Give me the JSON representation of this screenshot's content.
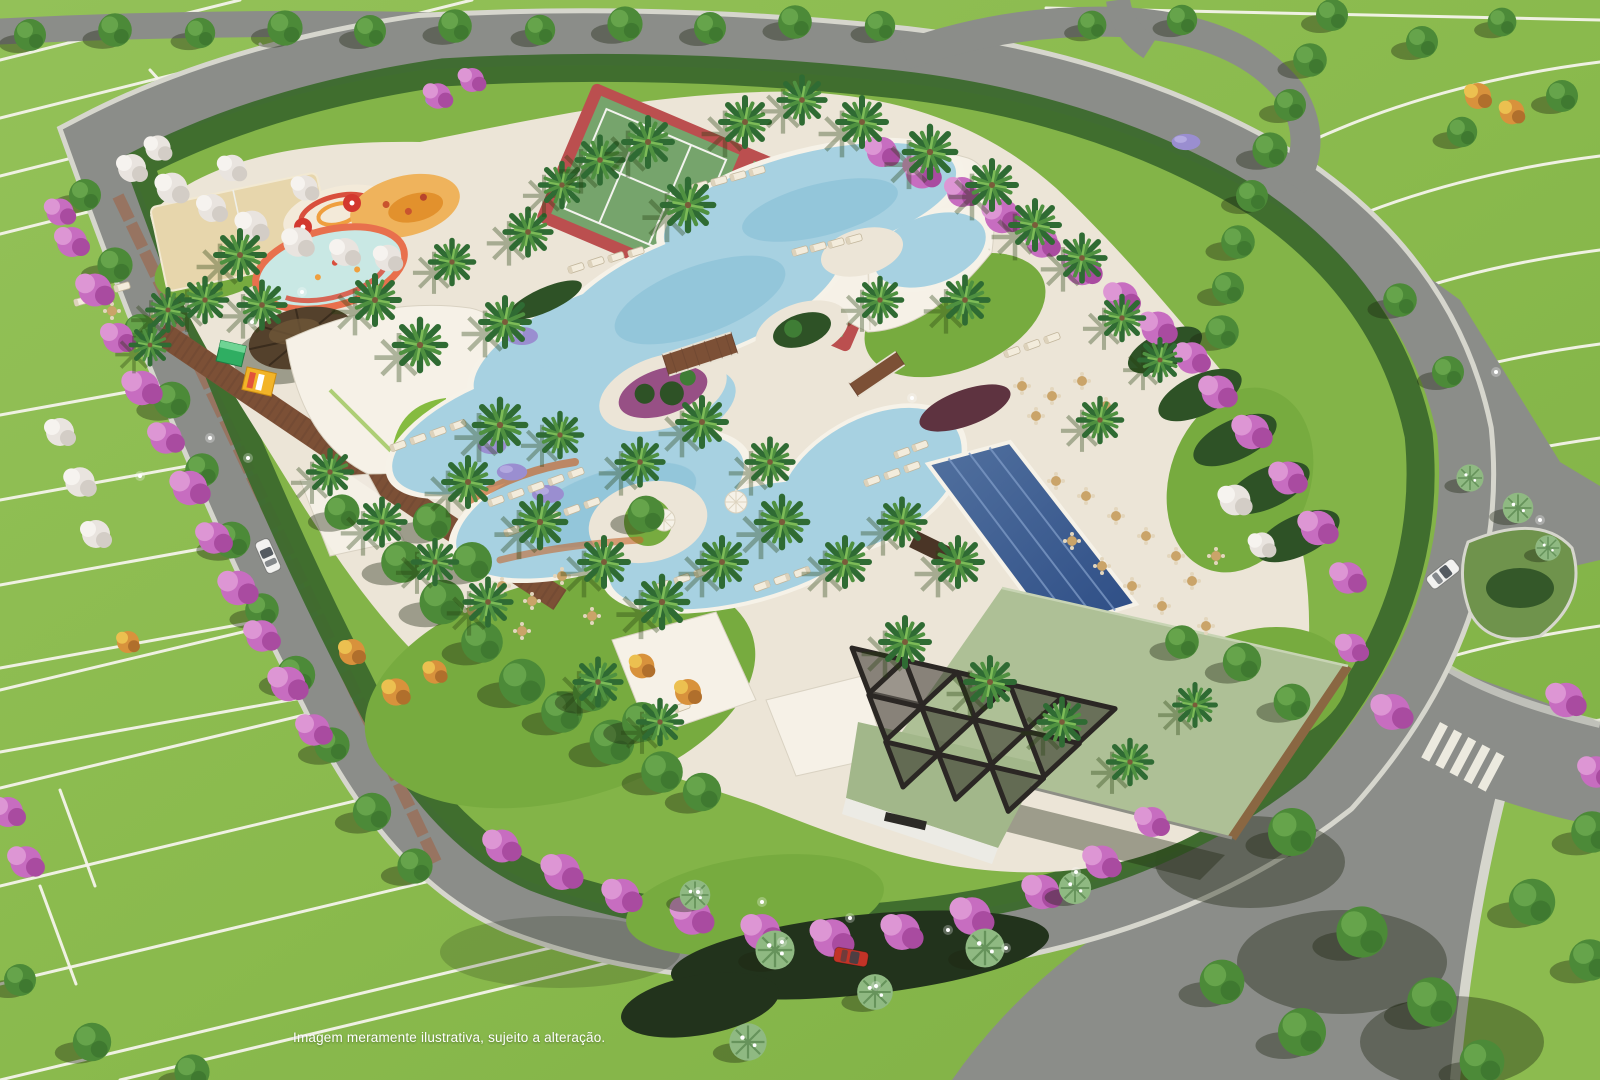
{
  "caption": {
    "text": "Imagem meramente ilustrativa, sujeito a alteração."
  },
  "palette": {
    "grass": "#8cbb4f",
    "grass_dark": "#7dae43",
    "lawn": "#83b448",
    "lawn2": "#77ab3f",
    "lot_line": "#f4f3ea",
    "road": "#8b8d89",
    "road_dark": "#7c7e7a",
    "sidewalk": "#d6d6cd",
    "deck": "#ece5d7",
    "deck_light": "#f6f1e7",
    "sand": "#e7d6ac",
    "hedge": "#3c6a2d",
    "water": "#a7d1e1",
    "water_deep": "#84bdd6",
    "coping": "#f6f2e8",
    "lap1": "#49699f",
    "lap2": "#2d4d85",
    "lane": "#7b98c4",
    "roof": "#aec096",
    "roof2": "#a2b78a",
    "wood": "#8a6742",
    "trellis": "#2b2724",
    "wall": "#ecebe5",
    "thatch": "#54412c",
    "board": "#7c5036",
    "brick": "#9a6e58",
    "pink": "#c76dc0",
    "pink2": "#a94ba0",
    "pink3": "#dd96d4",
    "white_bloom": "#e9e4df",
    "purple": "#9a8ed0",
    "orange_bloom": "#d8923c",
    "tree": "#4c8a38",
    "tree_dark": "#3c742e",
    "tree_light": "#66a44b",
    "palm_dark": "#2f6b33",
    "palm_mid": "#4f9140",
    "palm_light": "#7cbb57",
    "fan_palm": "#8fb982",
    "trunk": "#7a5b3a",
    "tennis_red": "#bb4f4f",
    "tennis_green": "#76a46c",
    "kids_ring": "#e8704d",
    "splash_red": "#d94f3d",
    "splash_orange": "#ef9f3f",
    "play_sand": "#efb35c",
    "truck_green": "#2fae62",
    "truck_yellow": "#f2b428",
    "car_red": "#c23327",
    "car_white": "#f2f2f0",
    "umbrella_red": "#d3382f",
    "shrub": "#2e5226",
    "shadow": "rgba(28,38,16,0.38)"
  },
  "scene": {
    "palms": [
      [
        240,
        255,
        1
      ],
      [
        205,
        300,
        0.9
      ],
      [
        168,
        310,
        0.85
      ],
      [
        262,
        305,
        0.95
      ],
      [
        150,
        345,
        0.8
      ],
      [
        375,
        300,
        1
      ],
      [
        420,
        345,
        1.05
      ],
      [
        452,
        262,
        0.9
      ],
      [
        505,
        322,
        1
      ],
      [
        528,
        232,
        0.95
      ],
      [
        562,
        185,
        0.9
      ],
      [
        600,
        160,
        0.95
      ],
      [
        648,
        142,
        1
      ],
      [
        688,
        205,
        1.05
      ],
      [
        745,
        122,
        1
      ],
      [
        802,
        100,
        0.95
      ],
      [
        862,
        122,
        1
      ],
      [
        930,
        152,
        1.05
      ],
      [
        992,
        185,
        1
      ],
      [
        1035,
        225,
        1
      ],
      [
        1082,
        258,
        0.95
      ],
      [
        1122,
        318,
        0.9
      ],
      [
        1160,
        360,
        0.85
      ],
      [
        1100,
        420,
        0.9
      ],
      [
        500,
        425,
        1.05
      ],
      [
        468,
        482,
        1
      ],
      [
        540,
        522,
        1.05
      ],
      [
        604,
        562,
        1
      ],
      [
        662,
        602,
        1.05
      ],
      [
        722,
        562,
        1
      ],
      [
        782,
        522,
        1.05
      ],
      [
        845,
        562,
        1
      ],
      [
        902,
        522,
        0.95
      ],
      [
        958,
        562,
        1
      ],
      [
        770,
        462,
        0.95
      ],
      [
        702,
        422,
        1
      ],
      [
        640,
        462,
        0.95
      ],
      [
        560,
        435,
        0.9
      ],
      [
        905,
        642,
        1
      ],
      [
        990,
        682,
        1
      ],
      [
        1062,
        722,
        0.95
      ],
      [
        1130,
        762,
        0.9
      ],
      [
        1195,
        705,
        0.85
      ],
      [
        330,
        472,
        0.9
      ],
      [
        382,
        522,
        0.95
      ],
      [
        435,
        562,
        0.9
      ],
      [
        488,
        602,
        0.95
      ],
      [
        598,
        682,
        0.95
      ],
      [
        660,
        722,
        0.9
      ],
      [
        880,
        300,
        0.9
      ],
      [
        965,
        300,
        0.95
      ]
    ],
    "fan_palms": [
      [
        775,
        950,
        1.15
      ],
      [
        875,
        992,
        1.05
      ],
      [
        985,
        948,
        1.15
      ],
      [
        748,
        1042,
        1.1
      ],
      [
        1075,
        888,
        0.95
      ],
      [
        1470,
        478,
        0.8
      ],
      [
        1518,
        508,
        0.9
      ],
      [
        1548,
        548,
        0.75
      ],
      [
        695,
        895,
        0.9
      ]
    ],
    "trees": [
      [
        30,
        35,
        1
      ],
      [
        115,
        30,
        1.05
      ],
      [
        200,
        33,
        0.95
      ],
      [
        285,
        28,
        1.1
      ],
      [
        370,
        31,
        1
      ],
      [
        455,
        26,
        1.05
      ],
      [
        540,
        30,
        0.95
      ],
      [
        625,
        24,
        1.1
      ],
      [
        710,
        28,
        1
      ],
      [
        795,
        22,
        1.05
      ],
      [
        880,
        26,
        0.95
      ],
      [
        85,
        195,
        1
      ],
      [
        115,
        265,
        1.1
      ],
      [
        140,
        330,
        1
      ],
      [
        172,
        400,
        1.15
      ],
      [
        202,
        470,
        1.05
      ],
      [
        232,
        540,
        1.15
      ],
      [
        262,
        610,
        1.05
      ],
      [
        296,
        675,
        1.2
      ],
      [
        332,
        745,
        1.1
      ],
      [
        372,
        812,
        1.2
      ],
      [
        415,
        866,
        1.1
      ],
      [
        1332,
        15,
        1
      ],
      [
        1310,
        60,
        1.05
      ],
      [
        1290,
        105,
        1
      ],
      [
        1270,
        150,
        1.1
      ],
      [
        1252,
        196,
        1
      ],
      [
        1238,
        242,
        1.05
      ],
      [
        1228,
        288,
        1
      ],
      [
        1222,
        332,
        1.05
      ],
      [
        1092,
        25,
        0.9
      ],
      [
        1182,
        20,
        0.95
      ],
      [
        1422,
        42,
        1
      ],
      [
        1502,
        22,
        0.9
      ],
      [
        1562,
        96,
        1
      ],
      [
        1462,
        132,
        0.95
      ],
      [
        1400,
        300,
        1.05
      ],
      [
        1448,
        372,
        1
      ],
      [
        1292,
        832,
        1.5
      ],
      [
        1362,
        932,
        1.6
      ],
      [
        1302,
        1032,
        1.5
      ],
      [
        1432,
        1002,
        1.55
      ],
      [
        1532,
        902,
        1.45
      ],
      [
        1592,
        832,
        1.3
      ],
      [
        1482,
        1062,
        1.4
      ],
      [
        1222,
        982,
        1.4
      ],
      [
        1590,
        960,
        1.3
      ],
      [
        92,
        1042,
        1.2
      ],
      [
        192,
        1072,
        1.1
      ],
      [
        20,
        980,
        1
      ],
      [
        402,
        562,
        1.3
      ],
      [
        442,
        602,
        1.4
      ],
      [
        482,
        642,
        1.3
      ],
      [
        522,
        682,
        1.45
      ],
      [
        562,
        712,
        1.3
      ],
      [
        612,
        742,
        1.4
      ],
      [
        662,
        772,
        1.3
      ],
      [
        702,
        792,
        1.2
      ],
      [
        432,
        522,
        1.2
      ],
      [
        472,
        562,
        1.25
      ],
      [
        592,
        692,
        1.2
      ],
      [
        642,
        722,
        1.25
      ],
      [
        342,
        512,
        1.1
      ],
      [
        646,
        514,
        1.15
      ],
      [
        1242,
        662,
        1.2
      ],
      [
        1292,
        702,
        1.15
      ],
      [
        1182,
        642,
        1.05
      ]
    ],
    "pink_trees": [
      [
        60,
        212,
        0.9
      ],
      [
        72,
        242,
        1
      ],
      [
        95,
        290,
        1.1
      ],
      [
        118,
        338,
        1
      ],
      [
        142,
        388,
        1.15
      ],
      [
        166,
        438,
        1.05
      ],
      [
        190,
        488,
        1.15
      ],
      [
        214,
        538,
        1.05
      ],
      [
        238,
        588,
        1.15
      ],
      [
        262,
        636,
        1.05
      ],
      [
        288,
        684,
        1.15
      ],
      [
        314,
        730,
        1.05
      ],
      [
        882,
        152,
        1
      ],
      [
        922,
        172,
        1.1
      ],
      [
        962,
        192,
        1
      ],
      [
        1002,
        216,
        1.15
      ],
      [
        1042,
        242,
        1.05
      ],
      [
        1082,
        268,
        1.15
      ],
      [
        1122,
        298,
        1.05
      ],
      [
        1158,
        328,
        1.1
      ],
      [
        1192,
        358,
        1.05
      ],
      [
        1218,
        392,
        1.1
      ],
      [
        1252,
        432,
        1.15
      ],
      [
        1288,
        478,
        1.1
      ],
      [
        1318,
        528,
        1.15
      ],
      [
        1348,
        578,
        1.05
      ],
      [
        502,
        846,
        1.1
      ],
      [
        562,
        872,
        1.2
      ],
      [
        622,
        896,
        1.15
      ],
      [
        692,
        916,
        1.25
      ],
      [
        762,
        932,
        1.2
      ],
      [
        832,
        938,
        1.25
      ],
      [
        902,
        932,
        1.2
      ],
      [
        972,
        916,
        1.25
      ],
      [
        1042,
        892,
        1.15
      ],
      [
        1102,
        862,
        1.1
      ],
      [
        1152,
        822,
        1
      ],
      [
        1392,
        712,
        1.2
      ],
      [
        1566,
        700,
        1.15
      ],
      [
        1596,
        772,
        1.05
      ],
      [
        1352,
        648,
        0.95
      ],
      [
        8,
        812,
        1
      ],
      [
        26,
        862,
        1.05
      ],
      [
        438,
        96,
        0.85
      ],
      [
        472,
        80,
        0.8
      ]
    ],
    "white_trees": [
      [
        132,
        168,
        1
      ],
      [
        172,
        188,
        1.1
      ],
      [
        212,
        208,
        1
      ],
      [
        252,
        226,
        1.1
      ],
      [
        298,
        242,
        1.05
      ],
      [
        345,
        252,
        1
      ],
      [
        388,
        258,
        0.95
      ],
      [
        158,
        148,
        0.9
      ],
      [
        232,
        168,
        0.95
      ],
      [
        305,
        188,
        0.9
      ],
      [
        60,
        432,
        1
      ],
      [
        80,
        482,
        1.05
      ],
      [
        96,
        534,
        1
      ],
      [
        1235,
        500,
        1.1
      ],
      [
        1262,
        545,
        0.9
      ]
    ],
    "orange_trees": [
      [
        1478,
        96,
        1
      ],
      [
        1512,
        112,
        0.95
      ],
      [
        352,
        652,
        1
      ],
      [
        396,
        692,
        1.05
      ],
      [
        642,
        666,
        0.95
      ],
      [
        688,
        692,
        1
      ],
      [
        128,
        642,
        0.85
      ],
      [
        435,
        672,
        0.9
      ]
    ],
    "purple_beds": [
      [
        522,
        336,
        1
      ],
      [
        492,
        446,
        0.9
      ],
      [
        512,
        472,
        0.95
      ],
      [
        548,
        494,
        1
      ],
      [
        438,
        100,
        0.8
      ],
      [
        1186,
        142,
        0.9
      ]
    ],
    "loungers": [
      [
        700,
        186,
        -16
      ],
      [
        719,
        181,
        -16
      ],
      [
        738,
        176,
        -16
      ],
      [
        757,
        171,
        -16
      ],
      [
        800,
        251,
        -16
      ],
      [
        818,
        247,
        -16
      ],
      [
        836,
        243,
        -16
      ],
      [
        854,
        239,
        -16
      ],
      [
        576,
        268,
        -18
      ],
      [
        596,
        262,
        -18
      ],
      [
        616,
        257,
        -18
      ],
      [
        636,
        252,
        -18
      ],
      [
        398,
        446,
        -20
      ],
      [
        418,
        439,
        -20
      ],
      [
        438,
        432,
        -20
      ],
      [
        458,
        425,
        -20
      ],
      [
        496,
        501,
        -20
      ],
      [
        516,
        494,
        -20
      ],
      [
        536,
        487,
        -20
      ],
      [
        556,
        480,
        -20
      ],
      [
        576,
        473,
        -20
      ],
      [
        512,
        531,
        -20
      ],
      [
        532,
        524,
        -20
      ],
      [
        552,
        517,
        -20
      ],
      [
        572,
        510,
        -20
      ],
      [
        592,
        503,
        -20
      ],
      [
        662,
        586,
        -20
      ],
      [
        682,
        579,
        -20
      ],
      [
        702,
        572,
        -20
      ],
      [
        722,
        565,
        -20
      ],
      [
        762,
        586,
        160
      ],
      [
        782,
        579,
        160
      ],
      [
        802,
        572,
        160
      ],
      [
        872,
        481,
        -20
      ],
      [
        892,
        474,
        -20
      ],
      [
        912,
        467,
        -20
      ],
      [
        902,
        453,
        -20
      ],
      [
        920,
        446,
        -20
      ],
      [
        82,
        301,
        -16
      ],
      [
        102,
        294,
        -16
      ],
      [
        122,
        287,
        -16
      ],
      [
        642,
        721,
        -20
      ],
      [
        662,
        714,
        -20
      ],
      [
        682,
        707,
        -20
      ],
      [
        1012,
        352,
        -20
      ],
      [
        1032,
        345,
        -20
      ],
      [
        1052,
        338,
        -20
      ]
    ],
    "tables": [
      [
        1022,
        386
      ],
      [
        1052,
        396
      ],
      [
        1082,
        381
      ],
      [
        1106,
        406
      ],
      [
        1036,
        416
      ],
      [
        1056,
        481
      ],
      [
        1086,
        496
      ],
      [
        1116,
        516
      ],
      [
        1146,
        536
      ],
      [
        1176,
        556
      ],
      [
        1102,
        566
      ],
      [
        1132,
        586
      ],
      [
        1162,
        606
      ],
      [
        1192,
        581
      ],
      [
        1216,
        556
      ],
      [
        1072,
        541
      ],
      [
        1206,
        626
      ],
      [
        502,
        586
      ],
      [
        532,
        601
      ],
      [
        562,
        576
      ],
      [
        592,
        616
      ],
      [
        522,
        631
      ],
      [
        472,
        611
      ],
      [
        112,
        311
      ],
      [
        152,
        321
      ]
    ],
    "umbrellas_white": [
      [
        736,
        502
      ],
      [
        664,
        520
      ]
    ],
    "umbrellas_red": [
      [
        303,
        227
      ],
      [
        352,
        203
      ]
    ],
    "sparkles": [
      [
        302,
        292
      ],
      [
        252,
        322
      ],
      [
        1496,
        372
      ],
      [
        1540,
        520
      ],
      [
        912,
        398
      ],
      [
        248,
        458
      ],
      [
        782,
        942
      ],
      [
        850,
        918
      ],
      [
        948,
        930
      ],
      [
        1006,
        948
      ],
      [
        140,
        476
      ],
      [
        210,
        438
      ],
      [
        876,
        986
      ],
      [
        762,
        902
      ],
      [
        698,
        892
      ],
      [
        1076,
        872
      ]
    ],
    "cars": [
      {
        "x": 268,
        "y": 556,
        "rot": -24,
        "color": "car_white"
      },
      {
        "x": 1443,
        "y": 574,
        "rot": 52,
        "color": "car_white"
      },
      {
        "x": 851,
        "y": 957,
        "rot": 100,
        "color": "car_red"
      }
    ]
  }
}
